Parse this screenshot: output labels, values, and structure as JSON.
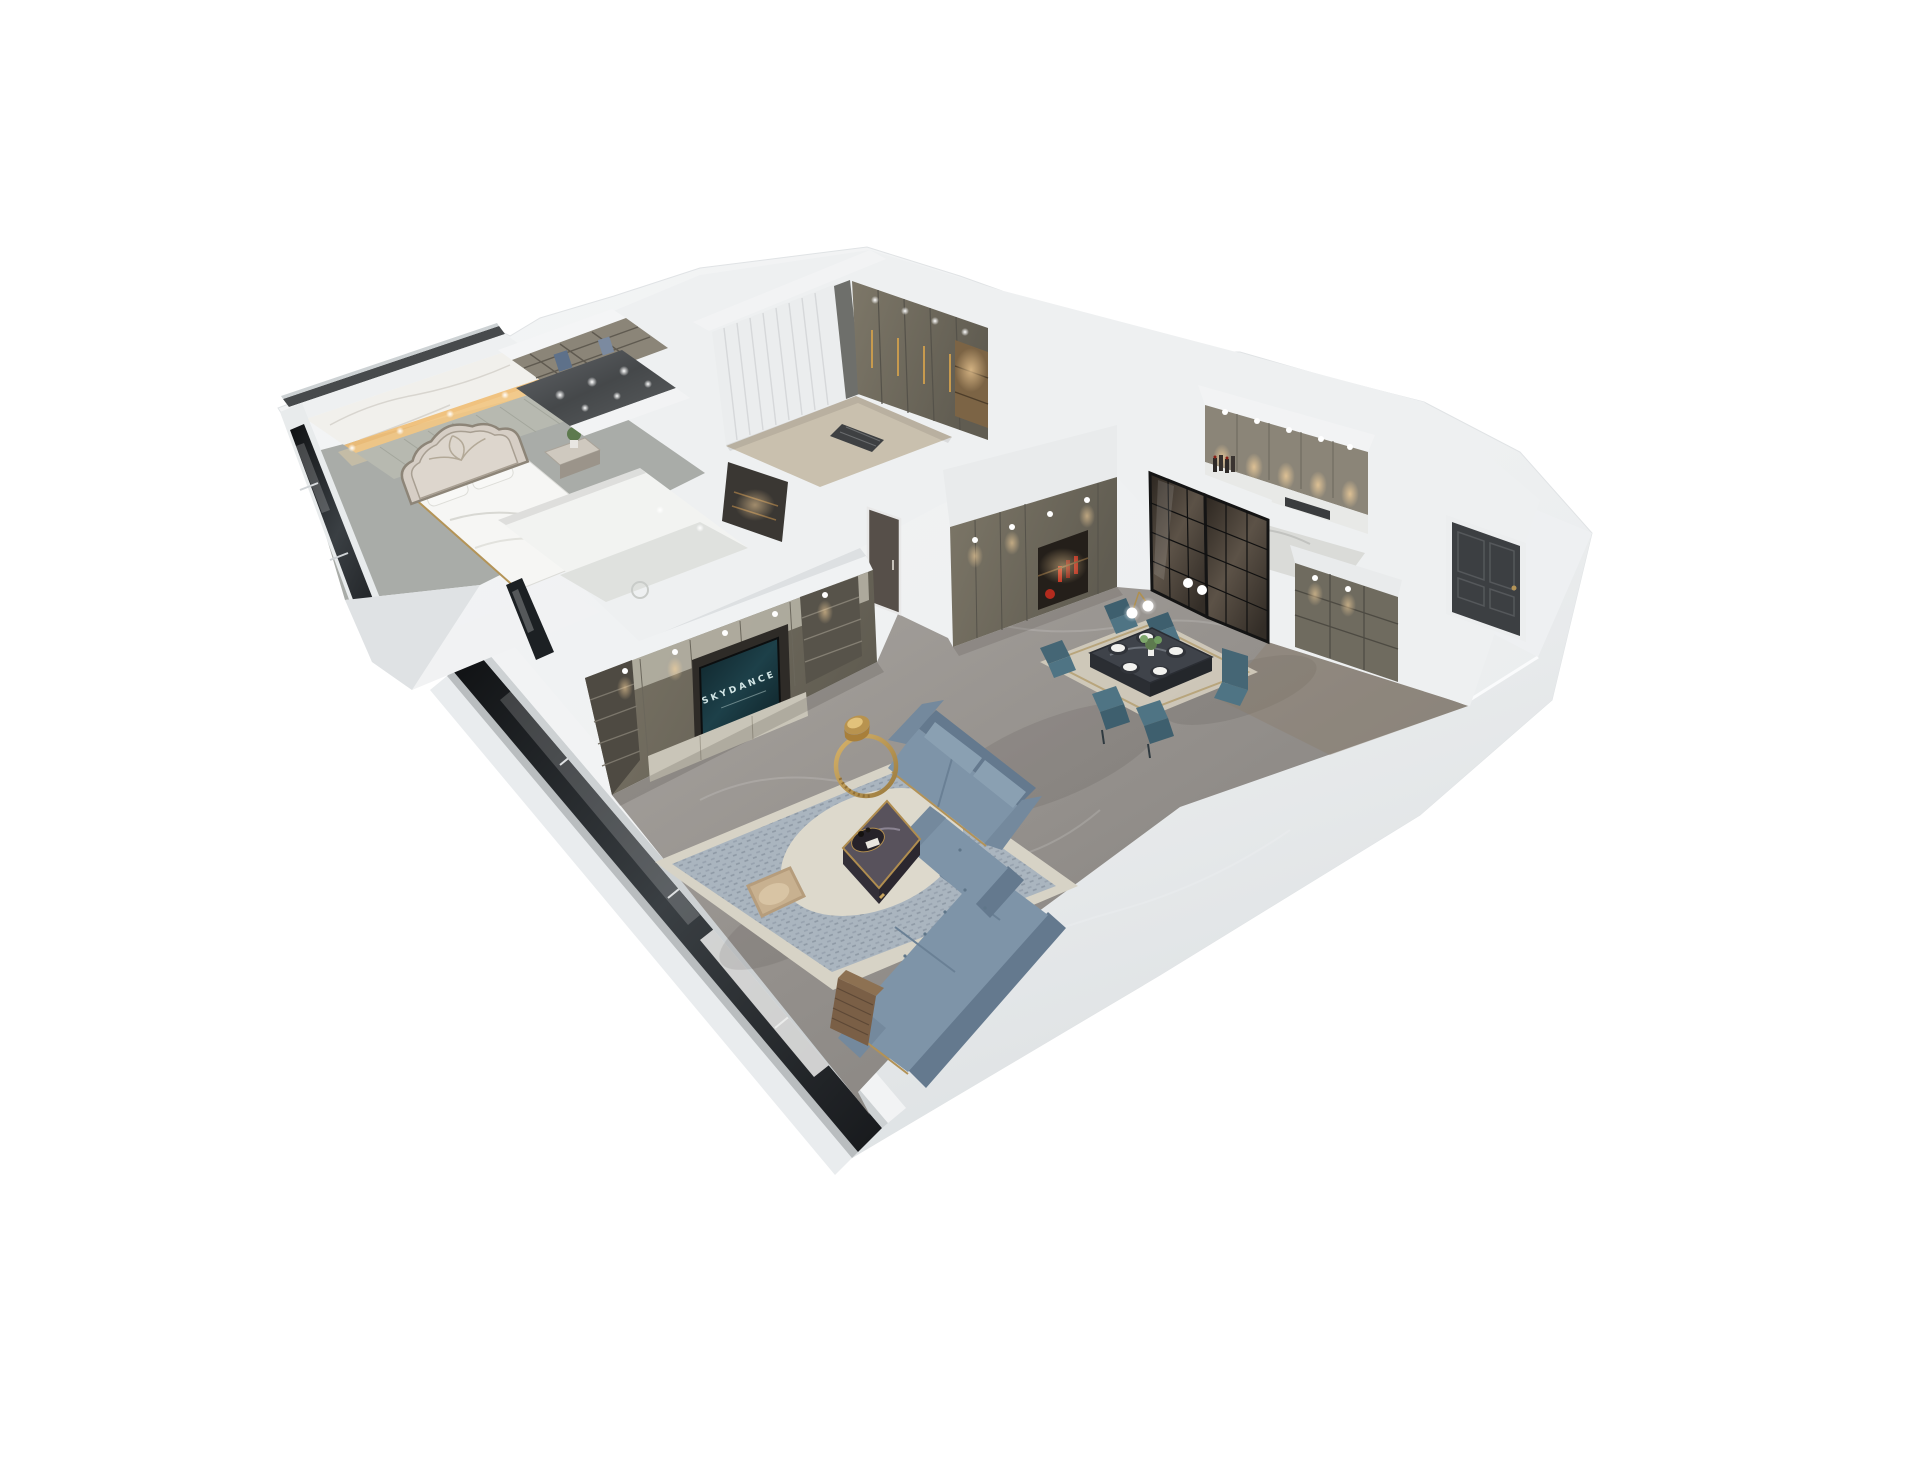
{
  "scene": {
    "type": "3d-floorplan-render",
    "style": "isometric cutaway dollhouse view of an apartment, white background",
    "background": "#ffffff"
  },
  "palette": {
    "wall": "#eff1f2",
    "wall_top": "#f6f7f8",
    "wall_shadow": "#d9dcde",
    "ledge_dark": "#474a4c",
    "floor_marble": "#938f8b",
    "floor_wood": "#c9c0ae",
    "floor_white": "#f2f3f1",
    "mirror_floor": "#55585a",
    "cabinet_dark": "#6f6b5f",
    "cabinet_mid": "#8b8578",
    "cabinet_light": "#b5b1a4",
    "sofa": "#7e94a8",
    "sofa_shadow": "#64798e",
    "rug_field": "#aab5bf",
    "rug_border": "#d7d3c6",
    "table_marble": "#58525c",
    "dining_table": "#3f434a",
    "dining_chair": "#4f7484",
    "gold": "#b8934f",
    "glass_dark": "#1c2023",
    "warm_light": "#f0bd72",
    "curtain": "#ebedee",
    "door_dark": "#3c3f42",
    "door_brown": "#564f49",
    "tv_screen": "#16343b",
    "accent_red": "#b32b1e",
    "headboard": "#d6cec5",
    "duvet": "#f6f6f4",
    "wainscot": "#b7b9b0",
    "plant": "#5d7a4e",
    "tan_chair": "#c8b190",
    "wood_slat": "#7a5f46"
  },
  "rooms": [
    {
      "id": "master-bedroom",
      "label": "Master bedroom",
      "items": [
        "upholstered bed",
        "white pillows",
        "nightstand",
        "potted plant",
        "marble accent wall",
        "warm cove lighting",
        "ribbed wainscot panel",
        "dark floor-to-ceiling windows"
      ]
    },
    {
      "id": "walk-in-closet",
      "label": "Walk-in closet",
      "items": [
        "wardrobe shelving",
        "hanging clothes",
        "mirror-gloss floor",
        "ceiling spotlights"
      ]
    },
    {
      "id": "bedroom-2",
      "label": "Bedroom",
      "items": [
        "sheer curtains",
        "gray curtain panel",
        "built-in wardrobe with brass pulls",
        "lit display niche",
        "floor vent grille"
      ]
    },
    {
      "id": "bathroom",
      "label": "Bathroom",
      "items": [
        "white stone floor",
        "round ceiling light",
        "dark corner window"
      ]
    },
    {
      "id": "hallway",
      "label": "Hallway",
      "items": [
        "interior door",
        "warm downlight"
      ]
    },
    {
      "id": "kitchen",
      "label": "Kitchen",
      "items": [
        "upper cabinets",
        "under-cabinet lighting",
        "counter with wine bottles",
        "dark cooktop",
        "black-framed glass partition doors",
        "pendant lights"
      ]
    },
    {
      "id": "dining-room",
      "label": "Dining room",
      "items": [
        "stone-top dining table",
        "six teal upholstered chairs",
        "white place settings",
        "flower centerpiece",
        "double globe pendant",
        "cream area rug",
        "display cabinet with red glassware niche"
      ]
    },
    {
      "id": "living-room",
      "label": "Living room",
      "items": [
        "full-height media wall",
        "flat TV",
        "blue loveseat sofa",
        "blue L-shaped sectional",
        "marble coffee table with decor tray",
        "standing gold ring decor",
        "gold drum stool",
        "tan accent chair",
        "two-tone patterned rug",
        "wood slat side cabinet",
        "window wall"
      ]
    },
    {
      "id": "entry",
      "label": "Entry",
      "items": [
        "dark paneled entrance door",
        "lit display cabinet"
      ]
    }
  ],
  "living_room": {
    "tv_brand_text": "SKYDANCE"
  }
}
